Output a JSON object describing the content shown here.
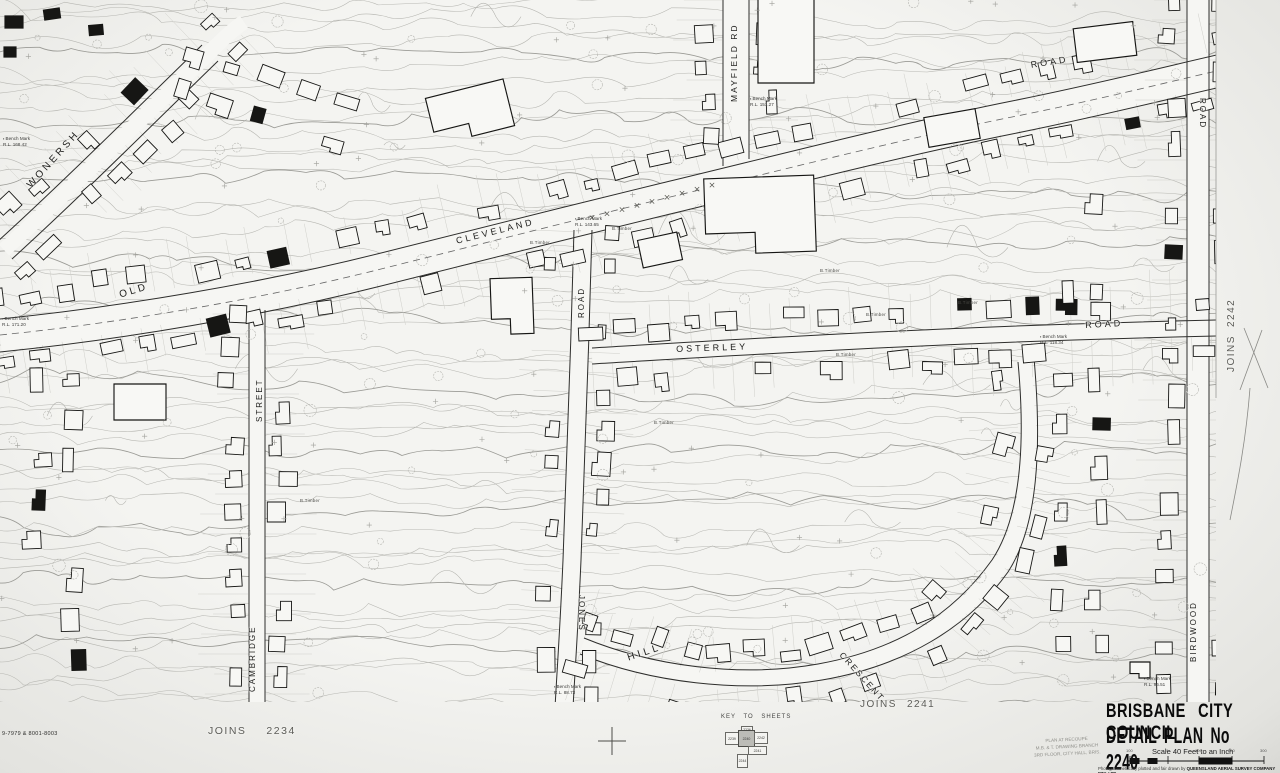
{
  "streets": {
    "wonersh": "WONERSH",
    "mayfield_rd": "MAYFIELD  RD",
    "old": "OLD",
    "cleveland": "CLEVELAND",
    "cleveland_road": "ROAD",
    "jones_road_upper": "ROAD",
    "jones": "JONES",
    "osterley": "OSTERLEY",
    "osterley_road": "ROAD",
    "cambridge_street": "STREET",
    "cambridge": "CAMBRIDGE",
    "hill": "HILL",
    "crescent": "CRESCENT",
    "birdwood": "BIRDWOOD",
    "birdwood_road": "ROAD"
  },
  "joins": {
    "bottom_left": {
      "word": "JOINS",
      "number": "2234"
    },
    "bottom_center": {
      "word": "JOINS",
      "number": "2241"
    },
    "right": {
      "word": "JOINS",
      "number": "2242"
    }
  },
  "title_block": {
    "line1": "BRISBANE CITY COUNCIL",
    "line2": "DETAIL PLAN No 2240",
    "scale": "Scale 40 Feet to an Inch",
    "scale_ticks": [
      "100",
      "0",
      "100",
      "200",
      "300"
    ],
    "credit_normal": "Photogrammetrically plotted and fair drawn by ",
    "credit_bold": "QUEENSLAND AERIAL SURVEY COMPANY PTY. LTD."
  },
  "key_to_sheets": {
    "label": "KEY TO SHEETS",
    "sheets": {
      "top": "2236",
      "left": "2239",
      "center": "2240",
      "right": "2242",
      "bottom_right": "2241",
      "bottom": "2244"
    }
  },
  "stamp": {
    "line1": "PLAN AT RECOUPE",
    "line2": "M.B. & T. DRAWING BRANCH",
    "line3": "3RD FLOOR, CITY HALL, BRIS."
  },
  "codes": {
    "sheet_code": "9-7979 & 8001-8003"
  },
  "annotations": {
    "b_timber": "B.Timber",
    "bench_marks": [
      "Bench Mark\nR.L. 151.27",
      "Bench Mark\nR.L. 143.65",
      "Bench Mark\nR.L. 118.34",
      "Bench Mark\nR.L. 96.51",
      "Bench Mark\nR.L. 88.73",
      "Bench Mark\nR.L. 168.42",
      "Bench Mark\nR.L. 171.20"
    ]
  }
}
